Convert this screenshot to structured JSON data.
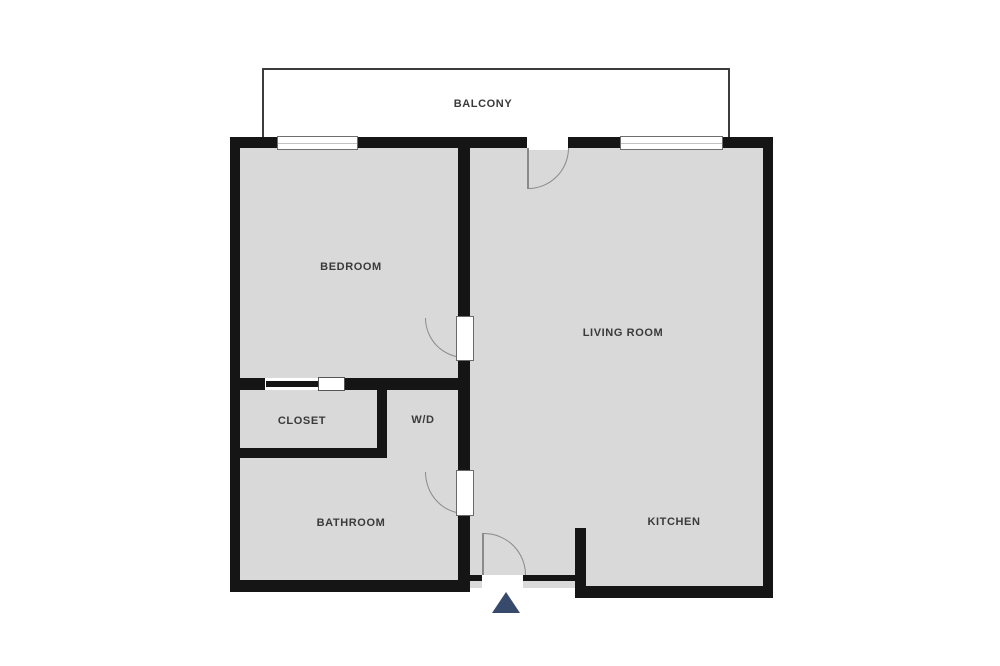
{
  "floor_plan": {
    "title": "One-bedroom apartment floor plan",
    "rooms": [
      {
        "name": "balcony",
        "label": "BALCONY"
      },
      {
        "name": "bedroom",
        "label": "BEDROOM"
      },
      {
        "name": "living_room",
        "label": "LIVING ROOM"
      },
      {
        "name": "closet",
        "label": "CLOSET"
      },
      {
        "name": "washer_dryer",
        "label": "W/D"
      },
      {
        "name": "bathroom",
        "label": "BATHROOM"
      },
      {
        "name": "kitchen",
        "label": "KITCHEN"
      }
    ],
    "features": [
      {
        "name": "window",
        "location": "bedroom top wall"
      },
      {
        "name": "window",
        "location": "living room top wall"
      },
      {
        "name": "swing-door",
        "location": "balcony to living room"
      },
      {
        "name": "swing-door",
        "location": "bedroom"
      },
      {
        "name": "swing-door",
        "location": "bathroom"
      },
      {
        "name": "pocket-door",
        "location": "closet"
      },
      {
        "name": "swing-door",
        "location": "main entry"
      },
      {
        "name": "entrance-arrow",
        "location": "below entry door"
      }
    ],
    "colors": {
      "background": "#ffffff",
      "floor": "#d9d9d9",
      "walls": "#151515",
      "door_swing": "#8a8a8a",
      "entrance_marker": "#384a6b",
      "label_text": "#3a3a3a"
    }
  }
}
